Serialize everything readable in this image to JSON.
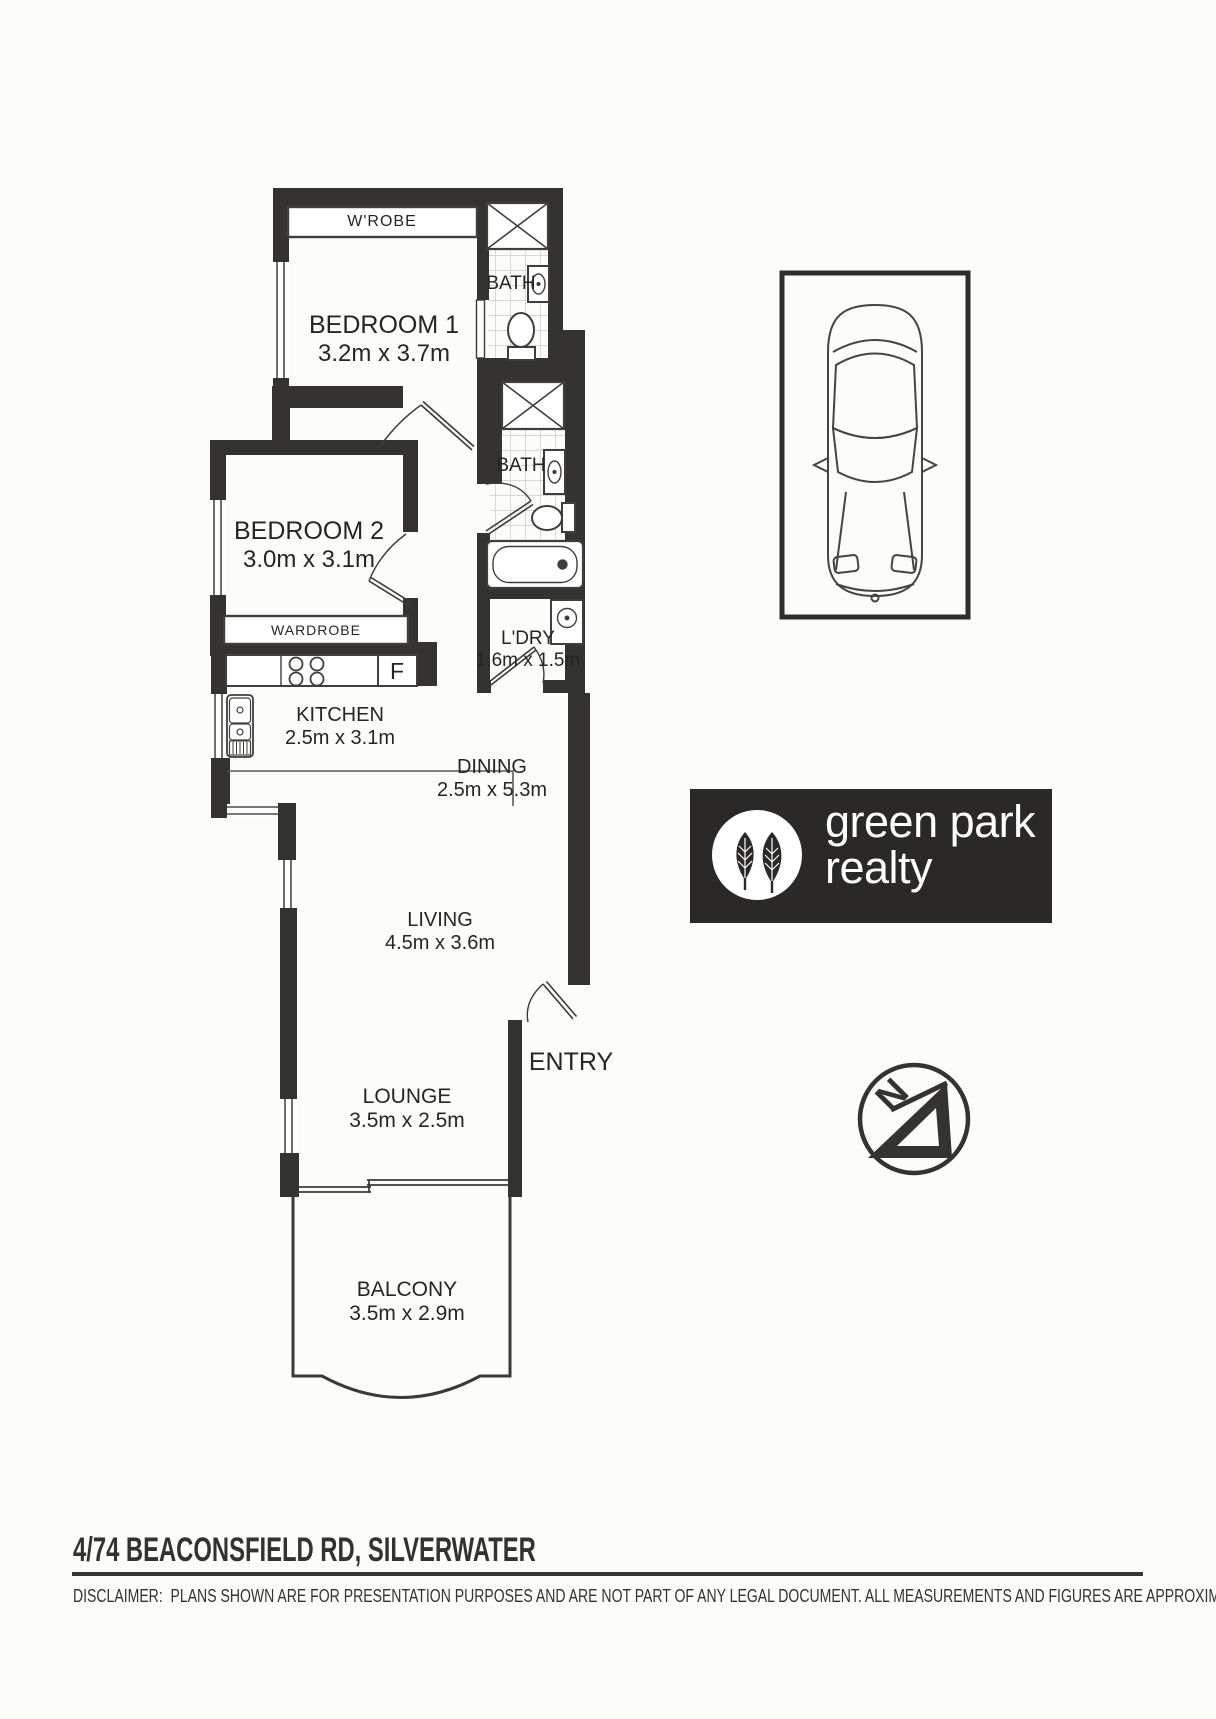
{
  "floorplan": {
    "rooms": [
      {
        "id": "wrobe",
        "label": "W'ROBE",
        "dims": ""
      },
      {
        "id": "bedroom1",
        "label": "BEDROOM 1",
        "dims": "3.2m x 3.7m"
      },
      {
        "id": "bath1",
        "label": "BATH",
        "dims": ""
      },
      {
        "id": "bedroom2",
        "label": "BEDROOM 2",
        "dims": "3.0m x 3.1m"
      },
      {
        "id": "wardrobe",
        "label": "WARDROBE",
        "dims": ""
      },
      {
        "id": "bath2",
        "label": "BATH",
        "dims": ""
      },
      {
        "id": "laundry",
        "label": "L'DRY",
        "dims": "1.6m x 1.5m"
      },
      {
        "id": "kitchen",
        "label": "KITCHEN",
        "dims": "2.5m x 3.1m"
      },
      {
        "id": "dining",
        "label": "DINING",
        "dims": "2.5m x 5.3m"
      },
      {
        "id": "living",
        "label": "LIVING",
        "dims": "4.5m x 3.6m"
      },
      {
        "id": "entry",
        "label": "ENTRY",
        "dims": ""
      },
      {
        "id": "lounge",
        "label": "LOUNGE",
        "dims": "3.5m x 2.5m"
      },
      {
        "id": "balcony",
        "label": "BALCONY",
        "dims": "3.5m x 2.9m"
      }
    ],
    "fridge_label": "F",
    "compass_label": "N",
    "wall_color": "#343330",
    "tile_color": "#c3c3bf"
  },
  "branding": {
    "line1": "green park",
    "line2": "realty",
    "logo_bg": "#2b2927",
    "logo_icon": "two-leaves"
  },
  "footer": {
    "address": "4/74 BEACONSFIELD RD, SILVERWATER",
    "disclaimer": "DISCLAIMER:  PLANS SHOWN ARE FOR PRESENTATION PURPOSES AND ARE NOT PART OF ANY LEGAL DOCUMENT. ALL MEASUREMENTS AND FIGURES ARE APPROXIMATE."
  }
}
